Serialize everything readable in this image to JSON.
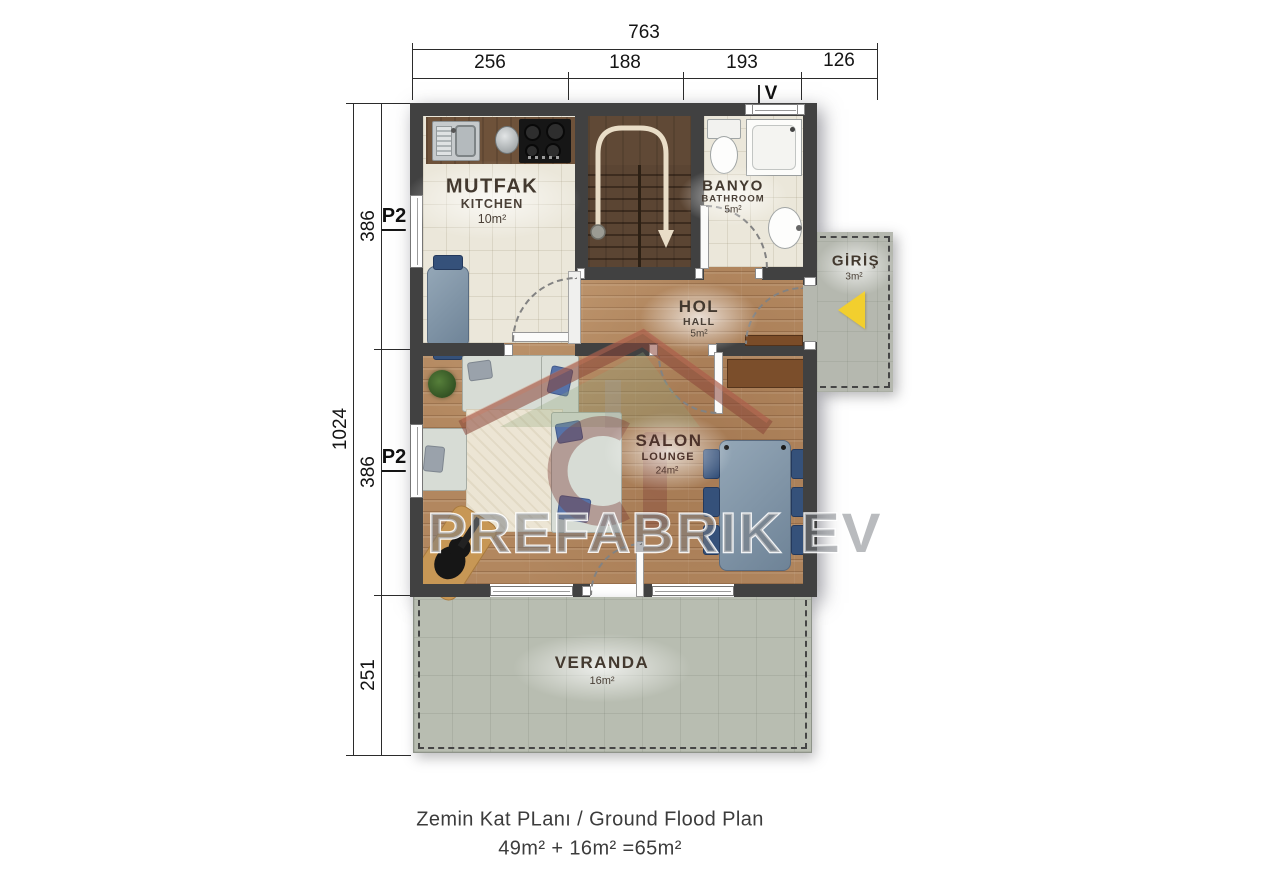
{
  "window_tags": {
    "p2": "P2",
    "p4": "P4",
    "vent": "V"
  },
  "dimensions": {
    "top": {
      "total": "763",
      "segments": [
        "256",
        "188",
        "193",
        "126"
      ]
    },
    "left": {
      "total": "1024",
      "segments": [
        "386",
        "386",
        "251"
      ]
    }
  },
  "rooms": {
    "kitchen": {
      "name": "MUTFAK",
      "sub": "KITCHEN",
      "area": "10m²"
    },
    "bathroom": {
      "name": "BANYO",
      "sub": "BATHROOM",
      "area": "5m²"
    },
    "hall": {
      "name": "HOL",
      "sub": "HALL",
      "area": "5m²"
    },
    "salon": {
      "name": "SALON",
      "sub": "LOUNGE",
      "area": "24m²"
    },
    "entrance": {
      "name": "GİRİŞ",
      "area": "3m²"
    },
    "veranda": {
      "name": "VERANDA",
      "area": "16m²"
    }
  },
  "watermark": {
    "text": "PREFABRIK EV"
  },
  "footer": {
    "title": "Zemin Kat PLanı / Ground Flood Plan",
    "equation": "49m² + 16m² =65m²"
  },
  "colors": {
    "wall": "#414141",
    "wood": "#b2875f",
    "tile": "#ebe7da",
    "stairs": "#5b4533",
    "veranda": "#b8bdb1",
    "platform": "#b5b8af",
    "arrow": "#f2cf2e",
    "logo_red": "#8a4638"
  }
}
